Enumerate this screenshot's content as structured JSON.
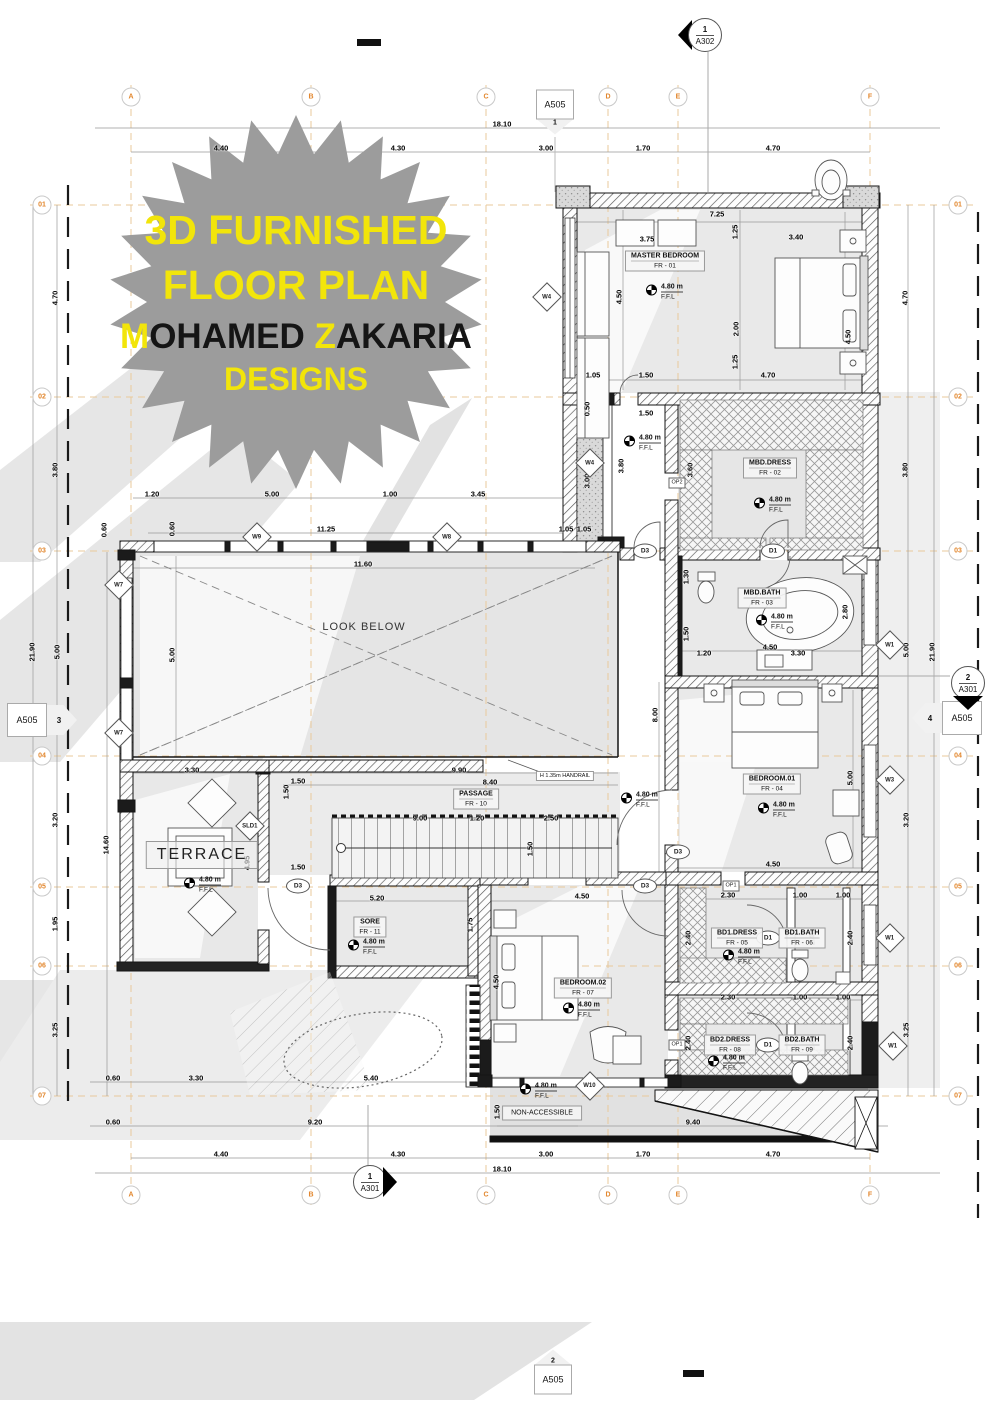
{
  "badge": {
    "l1": "3D FURNISHED",
    "l2": "FLOOR PLAN",
    "l3a": "M",
    "l3b": "OHAMED ",
    "l3c": "Z",
    "l3d": "AKARIA",
    "l4": "DESIGNS"
  },
  "ffl_text": {
    "value": "4.80 m",
    "ffl": "F.F.L"
  },
  "misc": {
    "look_below": "LOOK BELOW",
    "terrace": "TERRACE",
    "non_accessible": "NON-ACCESSIBLE",
    "handrail": "H 1.35m HANDRAIL"
  },
  "markers": {
    "a302_top": {
      "num": "1",
      "sheet": "A302"
    },
    "a505_top": {
      "num": "1",
      "sheet": "A505"
    },
    "a505_left": {
      "num": "3",
      "sheet": "A505"
    },
    "a505_right": {
      "num": "4",
      "sheet": "A505"
    },
    "a301_right": {
      "num": "2",
      "sheet": "A301"
    },
    "a301_bottom": {
      "num": "1",
      "sheet": "A301"
    },
    "a505_bottom": {
      "num": "2",
      "sheet": "A505"
    }
  },
  "grid": {
    "cols": [
      {
        "t": "A",
        "x": 131
      },
      {
        "t": "B",
        "x": 311
      },
      {
        "t": "C",
        "x": 486
      },
      {
        "t": "D",
        "x": 608
      },
      {
        "t": "E",
        "x": 678
      },
      {
        "t": "F",
        "x": 870
      }
    ],
    "rows": [
      {
        "t": "01",
        "y": 205
      },
      {
        "t": "02",
        "y": 397
      },
      {
        "t": "03",
        "y": 551
      },
      {
        "t": "04",
        "y": 756
      },
      {
        "t": "05",
        "y": 887
      },
      {
        "t": "06",
        "y": 966
      },
      {
        "t": "07",
        "y": 1096
      }
    ]
  },
  "rooms": [
    {
      "n": "MASTER BEDROOM",
      "c": "FR - 01",
      "x": 665,
      "y": 261
    },
    {
      "n": "MBD.DRESS",
      "c": "FR - 02",
      "x": 770,
      "y": 468
    },
    {
      "n": "MBD.BATH",
      "c": "FR - 03",
      "x": 762,
      "y": 598
    },
    {
      "n": "BEDROOM.01",
      "c": "FR - 04",
      "x": 772,
      "y": 784
    },
    {
      "n": "BD1.DRESS",
      "c": "FR - 05",
      "x": 737,
      "y": 938
    },
    {
      "n": "BD1.BATH",
      "c": "FR - 06",
      "x": 802,
      "y": 938
    },
    {
      "n": "BEDROOM.02",
      "c": "FR - 07",
      "x": 583,
      "y": 988
    },
    {
      "n": "BD2.DRESS",
      "c": "FR - 08",
      "x": 730,
      "y": 1045
    },
    {
      "n": "BD2.BATH",
      "c": "FR - 09",
      "x": 802,
      "y": 1045
    },
    {
      "n": "PASSAGE",
      "c": "FR - 10",
      "x": 476,
      "y": 799
    },
    {
      "n": "SORE",
      "c": "FR - 11",
      "x": 370,
      "y": 927
    }
  ],
  "window_tags": [
    {
      "t": "W4",
      "x": 547,
      "y": 297
    },
    {
      "t": "W4",
      "x": 590,
      "y": 463
    },
    {
      "t": "W9",
      "x": 257,
      "y": 537
    },
    {
      "t": "W8",
      "x": 447,
      "y": 537
    },
    {
      "t": "W7",
      "x": 119,
      "y": 585
    },
    {
      "t": "W7",
      "x": 119,
      "y": 733
    },
    {
      "t": "W1",
      "x": 890,
      "y": 645
    },
    {
      "t": "W3",
      "x": 890,
      "y": 780
    },
    {
      "t": "W1",
      "x": 890,
      "y": 938
    },
    {
      "t": "W1",
      "x": 893,
      "y": 1046
    },
    {
      "t": "W10",
      "x": 590,
      "y": 1086
    },
    {
      "t": "SLD1",
      "x": 250,
      "y": 826
    }
  ],
  "door_tags": [
    {
      "t": "D3",
      "x": 645,
      "y": 551
    },
    {
      "t": "D1",
      "x": 773,
      "y": 551
    },
    {
      "t": "D3",
      "x": 678,
      "y": 852
    },
    {
      "t": "D3",
      "x": 645,
      "y": 886
    },
    {
      "t": "D3",
      "x": 298,
      "y": 886
    },
    {
      "t": "D1",
      "x": 768,
      "y": 938
    },
    {
      "t": "D1",
      "x": 768,
      "y": 1045
    }
  ],
  "op_tags": [
    {
      "t": "OP2",
      "x": 677,
      "y": 483
    },
    {
      "t": "OP1",
      "x": 731,
      "y": 886
    },
    {
      "t": "OP1",
      "x": 677,
      "y": 1045
    }
  ],
  "ffl_points": [
    {
      "x": 650,
      "y": 292
    },
    {
      "x": 628,
      "y": 443
    },
    {
      "x": 758,
      "y": 505
    },
    {
      "x": 760,
      "y": 622
    },
    {
      "x": 625,
      "y": 800
    },
    {
      "x": 762,
      "y": 810
    },
    {
      "x": 727,
      "y": 957
    },
    {
      "x": 567,
      "y": 1010
    },
    {
      "x": 712,
      "y": 1063
    },
    {
      "x": 524,
      "y": 1091
    },
    {
      "x": 188,
      "y": 885
    },
    {
      "x": 352,
      "y": 947
    }
  ],
  "dims": [
    {
      "t": "18.10",
      "x": 502,
      "y": 124
    },
    {
      "t": "4.40",
      "x": 221,
      "y": 148
    },
    {
      "t": "4.30",
      "x": 398,
      "y": 148
    },
    {
      "t": "3.00",
      "x": 546,
      "y": 148
    },
    {
      "t": "1.70",
      "x": 643,
      "y": 148
    },
    {
      "t": "4.70",
      "x": 773,
      "y": 148
    },
    {
      "t": "7.25",
      "x": 717,
      "y": 214
    },
    {
      "t": "3.75",
      "x": 647,
      "y": 239
    },
    {
      "t": "3.40",
      "x": 796,
      "y": 237
    },
    {
      "t": "1.25",
      "x": 735,
      "y": 232,
      "r": 1
    },
    {
      "t": "4.50",
      "x": 619,
      "y": 297,
      "r": 1
    },
    {
      "t": "2.00",
      "x": 736,
      "y": 329,
      "r": 1
    },
    {
      "t": "4.50",
      "x": 848,
      "y": 337,
      "r": 1
    },
    {
      "t": "1.25",
      "x": 735,
      "y": 362,
      "r": 1
    },
    {
      "t": "1.05",
      "x": 593,
      "y": 375
    },
    {
      "t": "1.50",
      "x": 646,
      "y": 375
    },
    {
      "t": "4.70",
      "x": 768,
      "y": 375
    },
    {
      "t": "0.50",
      "x": 587,
      "y": 409,
      "r": 1
    },
    {
      "t": "1.50",
      "x": 646,
      "y": 413
    },
    {
      "t": "3.80",
      "x": 621,
      "y": 466,
      "r": 1
    },
    {
      "t": "3.00",
      "x": 587,
      "y": 481,
      "r": 1
    },
    {
      "t": "3.60",
      "x": 690,
      "y": 470,
      "r": 1
    },
    {
      "t": "1.05",
      "x": 584,
      "y": 529
    },
    {
      "t": "1.20",
      "x": 152,
      "y": 494
    },
    {
      "t": "5.00",
      "x": 272,
      "y": 494
    },
    {
      "t": "1.00",
      "x": 390,
      "y": 494
    },
    {
      "t": "3.45",
      "x": 478,
      "y": 494
    },
    {
      "t": "11.25",
      "x": 326,
      "y": 529
    },
    {
      "t": "0.60",
      "x": 104,
      "y": 530,
      "r": 1
    },
    {
      "t": "0.60",
      "x": 172,
      "y": 529,
      "r": 1
    },
    {
      "t": "1.05",
      "x": 566,
      "y": 529
    },
    {
      "t": "11.60",
      "x": 363,
      "y": 564
    },
    {
      "t": "5.00",
      "x": 172,
      "y": 655,
      "r": 1
    },
    {
      "t": "4.70",
      "x": 55,
      "y": 298,
      "r": 1
    },
    {
      "t": "3.80",
      "x": 55,
      "y": 470,
      "r": 1
    },
    {
      "t": "21.90",
      "x": 32,
      "y": 652,
      "r": 1
    },
    {
      "t": "5.00",
      "x": 57,
      "y": 652,
      "r": 1
    },
    {
      "t": "14.60",
      "x": 106,
      "y": 845,
      "r": 1
    },
    {
      "t": "3.20",
      "x": 55,
      "y": 820,
      "r": 1
    },
    {
      "t": "1.95",
      "x": 55,
      "y": 924,
      "r": 1
    },
    {
      "t": "3.25",
      "x": 55,
      "y": 1030,
      "r": 1
    },
    {
      "t": "4.70",
      "x": 905,
      "y": 298,
      "r": 1
    },
    {
      "t": "3.80",
      "x": 905,
      "y": 470,
      "r": 1
    },
    {
      "t": "21.90",
      "x": 932,
      "y": 652,
      "r": 1
    },
    {
      "t": "5.00",
      "x": 906,
      "y": 650,
      "r": 1
    },
    {
      "t": "3.20",
      "x": 906,
      "y": 820,
      "r": 1
    },
    {
      "t": "3.25",
      "x": 906,
      "y": 1030,
      "r": 1
    },
    {
      "t": "1.30",
      "x": 686,
      "y": 577,
      "r": 1
    },
    {
      "t": "1.50",
      "x": 686,
      "y": 634,
      "r": 1
    },
    {
      "t": "3.30",
      "x": 192,
      "y": 770
    },
    {
      "t": "9.90",
      "x": 459,
      "y": 770
    },
    {
      "t": "8.40",
      "x": 490,
      "y": 782
    },
    {
      "t": "1.50",
      "x": 298,
      "y": 781
    },
    {
      "t": "1.50",
      "x": 286,
      "y": 792,
      "r": 1
    },
    {
      "t": "1.50",
      "x": 298,
      "y": 867
    },
    {
      "t": "9.00",
      "x": 420,
      "y": 818
    },
    {
      "t": "1.20",
      "x": 477,
      "y": 818
    },
    {
      "t": "2.50",
      "x": 551,
      "y": 818
    },
    {
      "t": "1.50",
      "x": 530,
      "y": 849,
      "r": 1
    },
    {
      "t": "4.95",
      "x": 247,
      "y": 863,
      "r": 1
    },
    {
      "t": "5.20",
      "x": 377,
      "y": 898
    },
    {
      "t": "1.75",
      "x": 470,
      "y": 925,
      "r": 1
    },
    {
      "t": "4.50",
      "x": 582,
      "y": 896
    },
    {
      "t": "4.50",
      "x": 496,
      "y": 982,
      "r": 1
    },
    {
      "t": "8.00",
      "x": 655,
      "y": 715,
      "r": 1
    },
    {
      "t": "5.00",
      "x": 850,
      "y": 778,
      "r": 1
    },
    {
      "t": "4.50",
      "x": 773,
      "y": 864
    },
    {
      "t": "4.50",
      "x": 770,
      "y": 647
    },
    {
      "t": "3.30",
      "x": 798,
      "y": 653
    },
    {
      "t": "1.20",
      "x": 704,
      "y": 653
    },
    {
      "t": "2.80",
      "x": 845,
      "y": 612,
      "r": 1
    },
    {
      "t": "2.30",
      "x": 728,
      "y": 895
    },
    {
      "t": "1.00",
      "x": 800,
      "y": 895
    },
    {
      "t": "1.00",
      "x": 843,
      "y": 895
    },
    {
      "t": "2.40",
      "x": 688,
      "y": 938,
      "r": 1
    },
    {
      "t": "2.40",
      "x": 812,
      "y": 938,
      "r": 1
    },
    {
      "t": "2.40",
      "x": 850,
      "y": 938,
      "r": 1
    },
    {
      "t": "2.30",
      "x": 728,
      "y": 997
    },
    {
      "t": "1.00",
      "x": 800,
      "y": 997
    },
    {
      "t": "1.00",
      "x": 843,
      "y": 997
    },
    {
      "t": "2.40",
      "x": 688,
      "y": 1043,
      "r": 1
    },
    {
      "t": "2.40",
      "x": 812,
      "y": 1043,
      "r": 1
    },
    {
      "t": "2.40",
      "x": 850,
      "y": 1043,
      "r": 1
    },
    {
      "t": "9.40",
      "x": 693,
      "y": 1122
    },
    {
      "t": "0.60",
      "x": 113,
      "y": 1078
    },
    {
      "t": "3.30",
      "x": 196,
      "y": 1078
    },
    {
      "t": "5.40",
      "x": 371,
      "y": 1078
    },
    {
      "t": "0.60",
      "x": 113,
      "y": 1122
    },
    {
      "t": "9.20",
      "x": 315,
      "y": 1122
    },
    {
      "t": "1.50",
      "x": 497,
      "y": 1112,
      "r": 1
    },
    {
      "t": "4.40",
      "x": 221,
      "y": 1154
    },
    {
      "t": "4.30",
      "x": 398,
      "y": 1154
    },
    {
      "t": "3.00",
      "x": 546,
      "y": 1154
    },
    {
      "t": "1.70",
      "x": 643,
      "y": 1154
    },
    {
      "t": "4.70",
      "x": 773,
      "y": 1154
    },
    {
      "t": "18.10",
      "x": 502,
      "y": 1169
    }
  ]
}
